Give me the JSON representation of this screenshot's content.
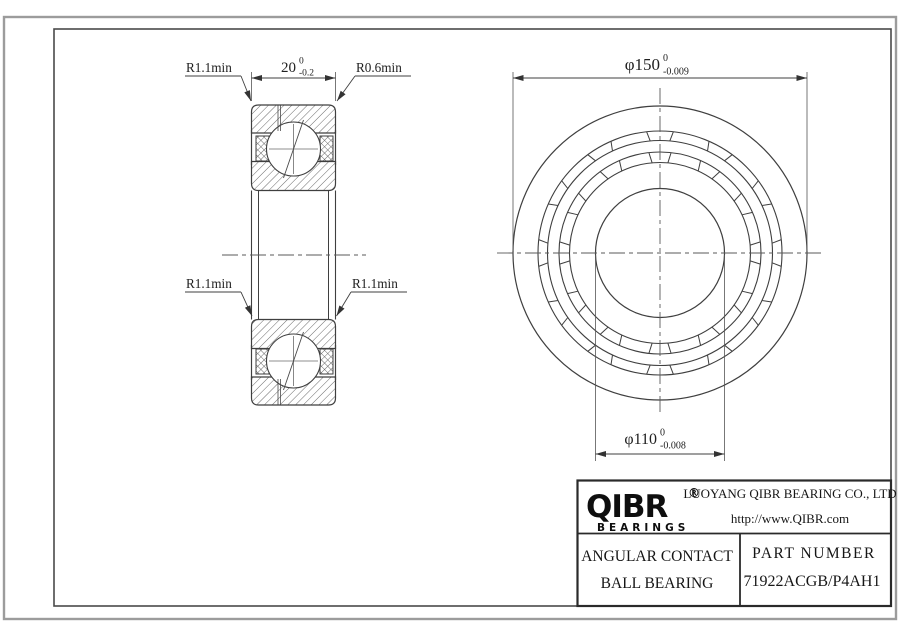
{
  "colors": {
    "background": "#ffffff",
    "line": "#3f3f3f",
    "hatch": "#5a5a5a",
    "border_outer": "#9c9c9c",
    "border_inner": "#4a4a4a",
    "text": "#202020"
  },
  "section_view": {
    "dim_width_value": "20",
    "dim_width_tol_top": "0",
    "dim_width_tol_bot": "-0.2",
    "label_radius_top_left": "R1.1min",
    "label_radius_top_right": "R0.6min",
    "label_radius_mid_left": "R1.1min",
    "label_radius_mid_right": "R1.1min"
  },
  "front_view": {
    "dim_od_value": "φ150",
    "dim_od_tol_top": "0",
    "dim_od_tol_bot": "-0.009",
    "dim_bore_value": "φ110",
    "dim_bore_tol_top": "0",
    "dim_bore_tol_bot": "-0.008"
  },
  "title_block": {
    "logo_text": "QIBR",
    "logo_registered": "®",
    "logo_subtitle": "BEARINGS",
    "company_name": "LUOYANG QIBR BEARING CO., LTD",
    "website": "http://www.QIBR.com",
    "product_type_line1": "ANGULAR CONTACT",
    "product_type_line2": "BALL BEARING",
    "part_number_label": "PART NUMBER",
    "part_number": "71922ACGB/P4AH1"
  }
}
